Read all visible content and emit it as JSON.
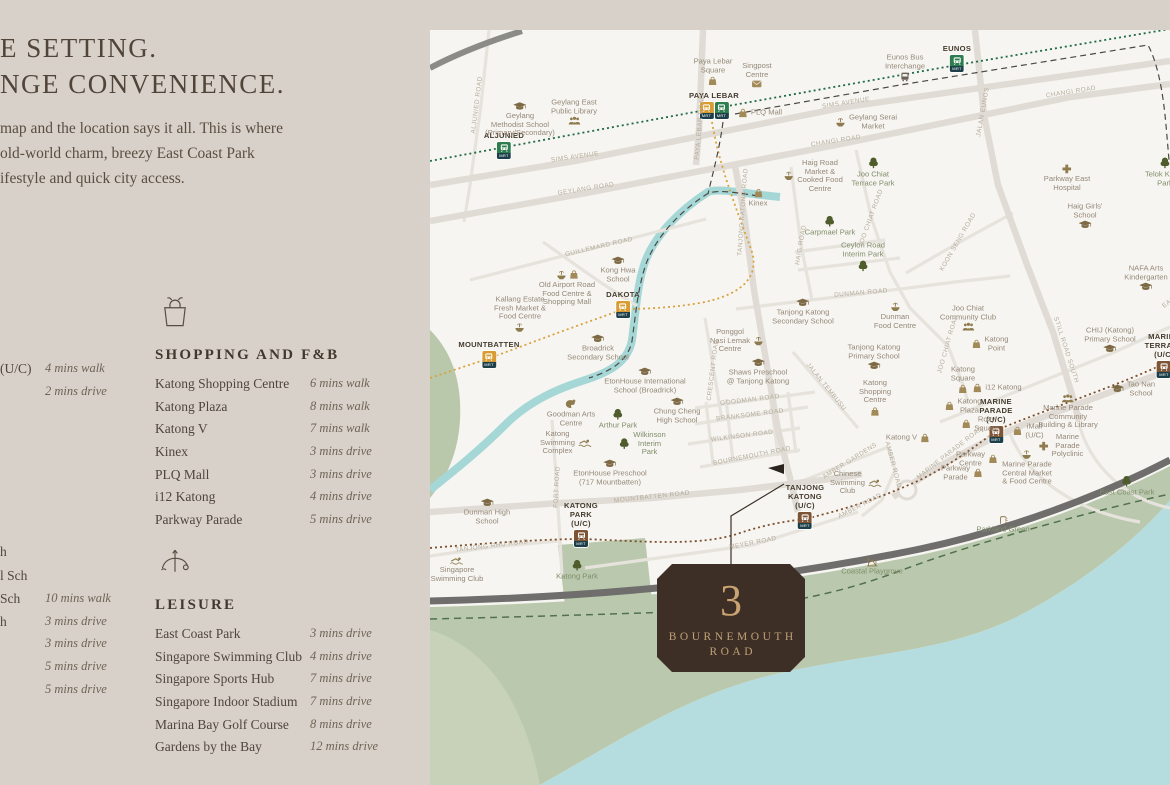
{
  "colors": {
    "panel_bg": "#d8d1c9",
    "map_bg": "#f7f5f1",
    "sea": "#b5dde0",
    "park": "#bac9ad",
    "road": "#e4e0da",
    "highway": "#6f6e6c",
    "river": "#a6d7d7",
    "ew_line": "#2e7d4f",
    "cc_line": "#d89c33",
    "te_line": "#7d5434",
    "logo_bg": "#3e2f26",
    "logo_gold": "#c9a472"
  },
  "intro": {
    "heading_lines": [
      "E SETTING.",
      "NGE CONVENIENCE."
    ],
    "body_lines": [
      "map and the location says it all. This is where",
      "old-world charm, breezy East Coast Park",
      "ifestyle and quick city access."
    ]
  },
  "edge_fragments": {
    "transport_rows": [
      {
        "name": "(U/C)",
        "time": "4 mins walk",
        "y": 361
      },
      {
        "name": "",
        "time": "2 mins drive",
        "y": 384
      }
    ],
    "education_rows": [
      {
        "name": "h",
        "time": "",
        "y": 544
      },
      {
        "name": "l Sch",
        "time": "",
        "y": 568
      },
      {
        "name": "Sch",
        "time": "10 mins walk",
        "y": 591
      },
      {
        "name": "h",
        "time": "3 mins drive",
        "y": 614
      },
      {
        "name": "",
        "time": "3 mins drive",
        "y": 636
      },
      {
        "name": "",
        "time": "5 mins drive",
        "y": 659
      },
      {
        "name": "",
        "time": "5 mins drive",
        "y": 682
      }
    ]
  },
  "sections": {
    "shopping": {
      "title": "SHOPPING AND F&B",
      "items": [
        {
          "name": "Katong Shopping Centre",
          "time": "6 mins walk"
        },
        {
          "name": "Katong Plaza",
          "time": "8 mins walk"
        },
        {
          "name": "Katong V",
          "time": "7 mins walk"
        },
        {
          "name": "Kinex",
          "time": "3 mins drive"
        },
        {
          "name": "PLQ Mall",
          "time": "3 mins drive"
        },
        {
          "name": "i12 Katong",
          "time": "4 mins drive"
        },
        {
          "name": "Parkway Parade",
          "time": "5 mins drive"
        }
      ]
    },
    "leisure": {
      "title": "LEISURE",
      "items": [
        {
          "name": "East Coast Park",
          "time": "3 mins drive"
        },
        {
          "name": "Singapore Swimming Club",
          "time": "4 mins drive"
        },
        {
          "name": "Singapore Sports Hub",
          "time": "7 mins drive"
        },
        {
          "name": "Singapore Indoor Stadium",
          "time": "7 mins drive"
        },
        {
          "name": "Marina Bay Golf Course",
          "time": "8 mins drive"
        },
        {
          "name": "Gardens by the Bay",
          "time": "12 mins drive"
        }
      ]
    }
  },
  "site_logo": {
    "numeral": "3",
    "line1": "BOURNEMOUTH",
    "line2": "ROAD"
  },
  "map": {
    "badge_text": "MRT",
    "stations": [
      {
        "lines": [
          "ALJUNIED"
        ],
        "badges": [
          "ew"
        ],
        "x": 504,
        "y": 131
      },
      {
        "lines": [
          "PAYA LEBAR"
        ],
        "badges": [
          "cc",
          "ew"
        ],
        "x": 714,
        "y": 91
      },
      {
        "lines": [
          "EUNOS"
        ],
        "badges": [
          "ew"
        ],
        "x": 957,
        "y": 44
      },
      {
        "lines": [
          "DAKOTA"
        ],
        "badges": [
          "cc"
        ],
        "x": 623,
        "y": 290
      },
      {
        "lines": [
          "MOUNTBATTEN"
        ],
        "badges": [
          "cc"
        ],
        "x": 489,
        "y": 340
      },
      {
        "lines": [
          "KATONG",
          "PARK",
          "(U/C)"
        ],
        "badges": [
          "te"
        ],
        "x": 581,
        "y": 501
      },
      {
        "lines": [
          "TANJONG",
          "KATONG",
          "(U/C)"
        ],
        "badges": [
          "te"
        ],
        "x": 805,
        "y": 483
      },
      {
        "lines": [
          "MARINE",
          "PARADE",
          "(U/C)"
        ],
        "badges": [
          "te"
        ],
        "x": 996,
        "y": 397
      },
      {
        "lines": [
          "MARINE",
          "TERRACE",
          "(U/C)"
        ],
        "badges": [
          "te"
        ],
        "x": 1164,
        "y": 332
      }
    ],
    "pois": [
      {
        "lines": [
          "Geylang",
          "Methodist School",
          "(Primary/Secondary)"
        ],
        "icon": "school",
        "pos": "top",
        "x": 520,
        "y": 120
      },
      {
        "lines": [
          "Geylang East",
          "Public Library"
        ],
        "icon": "people",
        "pos": "bottom",
        "x": 574,
        "y": 112
      },
      {
        "lines": [
          "Paya Lebar",
          "Square"
        ],
        "icon": "bag",
        "pos": "bottom",
        "x": 713,
        "y": 72
      },
      {
        "lines": [
          "Singpost",
          "Centre"
        ],
        "icon": "mail",
        "pos": "bottom",
        "x": 757,
        "y": 75
      },
      {
        "lines": [
          "PLQ Mall"
        ],
        "icon": "bag",
        "pos": "left",
        "x": 760,
        "y": 113
      },
      {
        "lines": [
          "Eunos Bus",
          "Interchange"
        ],
        "icon": "bus",
        "pos": "bottom",
        "x": 905,
        "y": 68
      },
      {
        "lines": [
          "Geylang Serai",
          "Market"
        ],
        "icon": "market",
        "pos": "left",
        "x": 866,
        "y": 122
      },
      {
        "lines": [
          "Haig Road",
          "Market &",
          "Cooked Food",
          "Centre"
        ],
        "icon": "market",
        "pos": "left",
        "x": 813,
        "y": 176
      },
      {
        "lines": [
          "Joo Chiat",
          "Terrace Park"
        ],
        "icon": "tree",
        "pos": "top",
        "x": 873,
        "y": 172,
        "cls": "park"
      },
      {
        "lines": [
          "Parkway East",
          "Hospital"
        ],
        "icon": "cross",
        "pos": "top",
        "x": 1067,
        "y": 178
      },
      {
        "lines": [
          "Telok Kurau",
          "Park"
        ],
        "icon": "tree",
        "pos": "top",
        "x": 1165,
        "y": 172,
        "cls": "park"
      },
      {
        "lines": [
          "Haig Girls'",
          "School"
        ],
        "icon": "school",
        "pos": "bottom",
        "x": 1085,
        "y": 216
      },
      {
        "lines": [
          "Carpmael Park"
        ],
        "icon": "tree",
        "pos": "top",
        "x": 830,
        "y": 226,
        "cls": "park"
      },
      {
        "lines": [
          "Ceylon Road",
          "Interim Park"
        ],
        "icon": "tree",
        "pos": "bottom",
        "x": 863,
        "y": 257,
        "cls": "park"
      },
      {
        "lines": [
          "Kinex"
        ],
        "icon": "bag",
        "pos": "top",
        "x": 758,
        "y": 198
      },
      {
        "lines": [
          "Kong Hwa",
          "School"
        ],
        "icon": "school",
        "pos": "top",
        "x": 618,
        "y": 270
      },
      {
        "lines": [
          "Old Airport Road",
          "Food Centre &",
          "Shopping Mall"
        ],
        "icon": "market-bag",
        "pos": "top",
        "x": 567,
        "y": 288
      },
      {
        "lines": [
          "Kallang Estate",
          "Fresh Market &",
          "Food Centre"
        ],
        "icon": "market",
        "pos": "bottom",
        "x": 520,
        "y": 314
      },
      {
        "lines": [
          "Dunman",
          "Food Centre"
        ],
        "icon": "market",
        "pos": "top",
        "x": 895,
        "y": 316
      },
      {
        "lines": [
          "Joo Chiat",
          "Community Club"
        ],
        "icon": "people",
        "pos": "bottom",
        "x": 968,
        "y": 318
      },
      {
        "lines": [
          "Katong",
          "Point"
        ],
        "icon": "bag",
        "pos": "left",
        "x": 990,
        "y": 344
      },
      {
        "lines": [
          "Tanjong Katong",
          "Secondary School"
        ],
        "icon": "school",
        "pos": "top",
        "x": 803,
        "y": 312
      },
      {
        "lines": [
          "Ponggol",
          "Nasi Lemak",
          "Centre"
        ],
        "icon": "market",
        "pos": "right",
        "x": 737,
        "y": 341
      },
      {
        "lines": [
          "Shaws Preschool",
          "@ Tanjong Katong"
        ],
        "icon": "school",
        "pos": "top",
        "x": 758,
        "y": 372
      },
      {
        "lines": [
          "Tanjong Katong",
          "Primary School"
        ],
        "icon": "school",
        "pos": "bottom",
        "x": 874,
        "y": 357
      },
      {
        "lines": [
          "Katong",
          "Shopping",
          "Centre"
        ],
        "icon": "bag",
        "pos": "bottom",
        "x": 875,
        "y": 398
      },
      {
        "lines": [
          "Katong",
          "Square"
        ],
        "icon": "bag",
        "pos": "bottom",
        "x": 963,
        "y": 380
      },
      {
        "lines": [
          "i12 Katong"
        ],
        "icon": "bag",
        "pos": "left",
        "x": 997,
        "y": 388
      },
      {
        "lines": [
          "Katong",
          "Plaza"
        ],
        "icon": "bag",
        "pos": "left",
        "x": 963,
        "y": 406
      },
      {
        "lines": [
          "Roxy",
          "Square"
        ],
        "icon": "bag",
        "pos": "left",
        "x": 980,
        "y": 424
      },
      {
        "lines": [
          "Katong V"
        ],
        "icon": "bag",
        "pos": "right",
        "x": 908,
        "y": 438
      },
      {
        "lines": [
          "iMall",
          "(U/C)"
        ],
        "icon": "bag",
        "pos": "left",
        "x": 1028,
        "y": 431
      },
      {
        "lines": [
          "Marine Parade",
          "Community",
          "Building & Library"
        ],
        "icon": "people",
        "pos": "top",
        "x": 1068,
        "y": 412
      },
      {
        "lines": [
          "Marine",
          "Parade",
          "Polyclinic"
        ],
        "icon": "cross",
        "pos": "left",
        "x": 1061,
        "y": 446
      },
      {
        "lines": [
          "Marine Parade",
          "Central Market",
          "& Food Centre"
        ],
        "icon": "market",
        "pos": "top",
        "x": 1027,
        "y": 468
      },
      {
        "lines": [
          "Parkway",
          "Centre"
        ],
        "icon": "bag",
        "pos": "right",
        "x": 977,
        "y": 459
      },
      {
        "lines": [
          "Parkway",
          "Parade"
        ],
        "icon": "bag",
        "pos": "right",
        "x": 962,
        "y": 473
      },
      {
        "lines": [
          "Tao Nan",
          "School"
        ],
        "icon": "school",
        "pos": "left",
        "x": 1133,
        "y": 389
      },
      {
        "lines": [
          "CHIJ (Katong)",
          "Primary School"
        ],
        "icon": "school",
        "pos": "bottom",
        "x": 1110,
        "y": 340
      },
      {
        "lines": [
          "NAFA Arts",
          "Kindergarten"
        ],
        "icon": "school",
        "pos": "bottom",
        "x": 1146,
        "y": 278
      },
      {
        "lines": [
          "Chinese",
          "Swimming",
          "Club"
        ],
        "icon": "swim",
        "pos": "right",
        "x": 856,
        "y": 483
      },
      {
        "lines": [
          "East Coast Park"
        ],
        "icon": "tree",
        "pos": "top",
        "x": 1127,
        "y": 486,
        "cls": "park"
      },
      {
        "lines": [
          "Parkland Green"
        ],
        "icon": "shower",
        "pos": "top",
        "x": 1003,
        "y": 525,
        "cls": "park"
      },
      {
        "lines": [
          "Coastal Playgrove"
        ],
        "icon": "playground",
        "pos": "top",
        "x": 872,
        "y": 567,
        "cls": "park"
      },
      {
        "lines": [
          "Broadrick",
          "Secondary School"
        ],
        "icon": "school",
        "pos": "top",
        "x": 598,
        "y": 348
      },
      {
        "lines": [
          "EtonHouse International",
          "School (Broadrick)"
        ],
        "icon": "school",
        "pos": "top",
        "x": 645,
        "y": 381
      },
      {
        "lines": [
          "Goodman Arts",
          "Centre"
        ],
        "icon": "palette",
        "pos": "top",
        "x": 571,
        "y": 413
      },
      {
        "lines": [
          "Arthur Park"
        ],
        "icon": "tree",
        "pos": "top",
        "x": 618,
        "y": 419,
        "cls": "park"
      },
      {
        "lines": [
          "Chung Cheng",
          "High School"
        ],
        "icon": "school",
        "pos": "top",
        "x": 677,
        "y": 411
      },
      {
        "lines": [
          "Wilkinson",
          "Interim",
          "Park"
        ],
        "icon": "tree",
        "pos": "left",
        "x": 642,
        "y": 444,
        "cls": "park"
      },
      {
        "lines": [
          "Katong",
          "Swimming",
          "Complex"
        ],
        "icon": "swim",
        "pos": "right",
        "x": 566,
        "y": 443
      },
      {
        "lines": [
          "EtonHouse Preschool",
          "(717 Mountbatten)"
        ],
        "icon": "school",
        "pos": "top",
        "x": 610,
        "y": 473
      },
      {
        "lines": [
          "Dunman High",
          "School"
        ],
        "icon": "school",
        "pos": "top",
        "x": 487,
        "y": 512
      },
      {
        "lines": [
          "Singapore",
          "Swimming Club"
        ],
        "icon": "swim",
        "pos": "top",
        "x": 457,
        "y": 570
      },
      {
        "lines": [
          "Katong Park"
        ],
        "icon": "tree",
        "pos": "top",
        "x": 577,
        "y": 570,
        "cls": "park"
      }
    ],
    "road_labels": [
      {
        "t": "SIMS AVENUE",
        "x": 575,
        "y": 157,
        "r": -8
      },
      {
        "t": "SIMS AVENUE",
        "x": 846,
        "y": 103,
        "r": -9
      },
      {
        "t": "GEYLANG ROAD",
        "x": 586,
        "y": 189,
        "r": -9
      },
      {
        "t": "CHANGI ROAD",
        "x": 836,
        "y": 141,
        "r": -9
      },
      {
        "t": "CHANGI ROAD",
        "x": 1071,
        "y": 92,
        "r": -9
      },
      {
        "t": "GUILLEMARD ROAD",
        "x": 599,
        "y": 247,
        "r": -13
      },
      {
        "t": "ALJUNIED ROAD",
        "x": 477,
        "y": 105,
        "r": -83
      },
      {
        "t": "PAYA LEBAR ROAD",
        "x": 700,
        "y": 127,
        "r": -85
      },
      {
        "t": "JALAN EUNOS",
        "x": 983,
        "y": 112,
        "r": -80
      },
      {
        "t": "TANJONG KATONG ROAD",
        "x": 743,
        "y": 212,
        "r": -86
      },
      {
        "t": "HAIG ROAD",
        "x": 801,
        "y": 245,
        "r": -80
      },
      {
        "t": "JOO CHIAT ROAD",
        "x": 871,
        "y": 218,
        "r": -70
      },
      {
        "t": "JOO CHIAT ROAD",
        "x": 948,
        "y": 344,
        "r": -74
      },
      {
        "t": "KOON SENG ROAD",
        "x": 958,
        "y": 242,
        "r": -60
      },
      {
        "t": "DUNMAN ROAD",
        "x": 861,
        "y": 293,
        "r": -5
      },
      {
        "t": "CRESCENT ROAD",
        "x": 713,
        "y": 370,
        "r": -83
      },
      {
        "t": "GOODMAN ROAD",
        "x": 750,
        "y": 400,
        "r": -7
      },
      {
        "t": "BRANKSOME ROAD",
        "x": 750,
        "y": 415,
        "r": -7
      },
      {
        "t": "WILKINSON ROAD",
        "x": 742,
        "y": 436,
        "r": -7
      },
      {
        "t": "BOURNEMOUTH ROAD",
        "x": 752,
        "y": 456,
        "r": -11
      },
      {
        "t": "JALAN TEMBUSU",
        "x": 826,
        "y": 387,
        "r": 51
      },
      {
        "t": "STILL ROAD SOUTH",
        "x": 1066,
        "y": 350,
        "r": 72
      },
      {
        "t": "MOUNTBATTEN ROAD",
        "x": 652,
        "y": 497,
        "r": -6
      },
      {
        "t": "FORT ROAD",
        "x": 557,
        "y": 487,
        "r": -87
      },
      {
        "t": "TANJONG RHU ROAD",
        "x": 492,
        "y": 546,
        "r": -7
      },
      {
        "t": "MEYER ROAD",
        "x": 753,
        "y": 543,
        "r": -11
      },
      {
        "t": "AMBER GARDENS",
        "x": 850,
        "y": 461,
        "r": -32
      },
      {
        "t": "AMBER ROAD",
        "x": 893,
        "y": 465,
        "r": 75
      },
      {
        "t": "AMBER ROAD",
        "x": 860,
        "y": 506,
        "r": -27
      },
      {
        "t": "MARINE PARADE ROAD",
        "x": 950,
        "y": 453,
        "r": -38
      },
      {
        "t": "EAST COAST ROAD",
        "x": 1190,
        "y": 286,
        "r": -38
      }
    ]
  }
}
